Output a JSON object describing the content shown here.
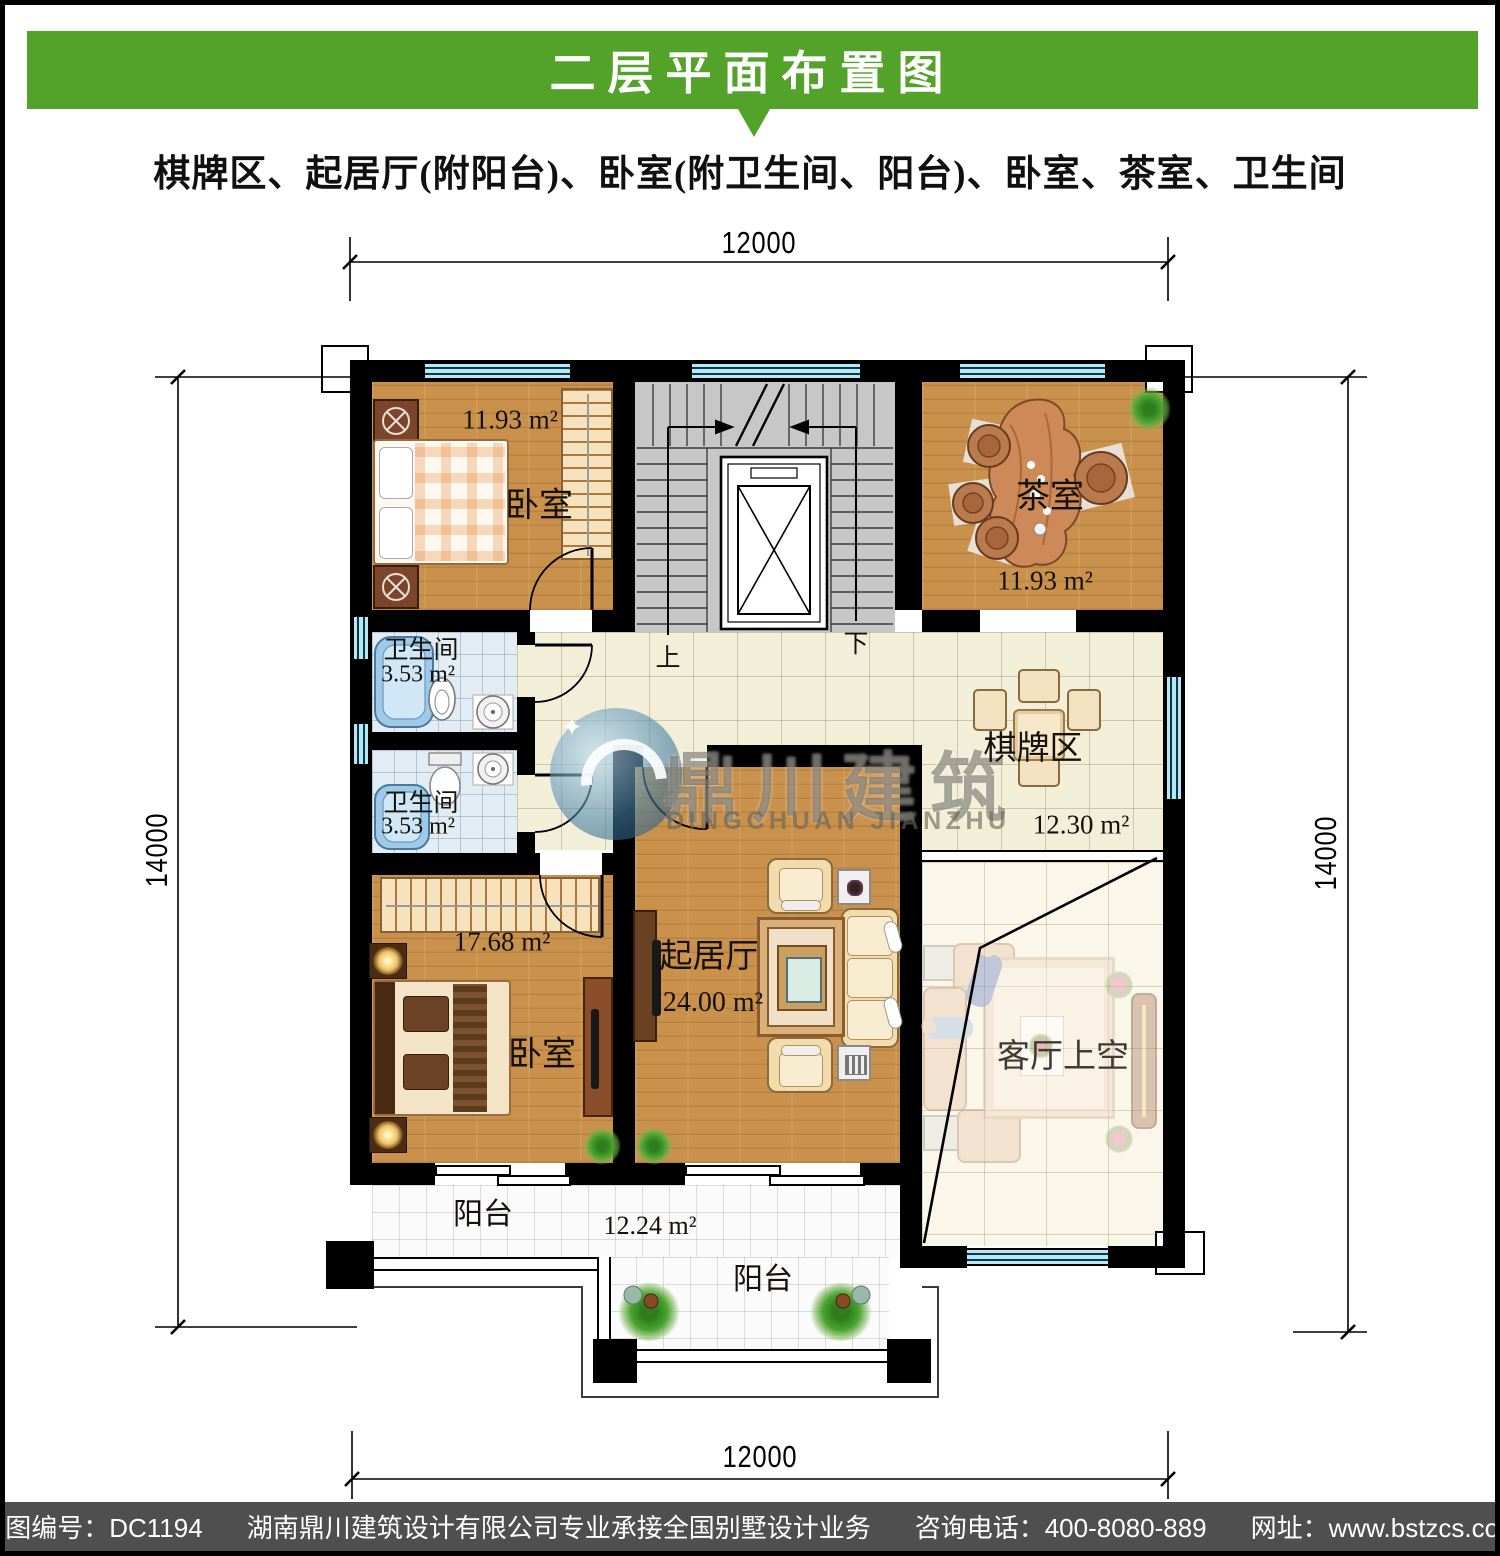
{
  "header": {
    "title": "二层平面布置图",
    "subtitle": "棋牌区、起居厅(附阳台)、卧室(附卫生间、阳台)、卧室、茶室、卫生间"
  },
  "dimensions": {
    "top": "12000",
    "bottom": "12000",
    "left": "14000",
    "right": "14000"
  },
  "rooms": {
    "bedroom_top": {
      "name": "卧室",
      "area": "11.93 m²"
    },
    "tea_room": {
      "name": "茶室",
      "area": "11.93 m²"
    },
    "bath_1": {
      "name": "卫生间",
      "area": "3.53 m²"
    },
    "bath_2": {
      "name": "卫生间",
      "area": "3.53 m²"
    },
    "chess_area": {
      "name": "棋牌区",
      "area": "12.30 m²"
    },
    "bedroom_bottom": {
      "name": "卧室",
      "area": "17.68 m²"
    },
    "living_room": {
      "name": "起居厅",
      "area": "24.00 m²"
    },
    "void": {
      "name": "客厅上空"
    },
    "balcony_main": {
      "name": "阳台",
      "area": "12.24 m²"
    },
    "balcony_outer": {
      "name": "阳台"
    }
  },
  "stairs": {
    "up": "上",
    "down": "下"
  },
  "watermark": {
    "cn": "鼎川建筑",
    "en": "DINGCHUAN JIANZHU",
    "sparkle": "✦"
  },
  "footer": {
    "drawing_no": "本图编号：DC1194",
    "company": "湖南鼎川建筑设计有限公司专业承接全国别墅设计业务",
    "phone": "咨询电话：400-8080-889",
    "website": "网址：www.bstzcs.com"
  },
  "colors": {
    "header_green": "#53a32a",
    "footer_gray": "#4f4f4f",
    "wall_black": "#000000",
    "window_cyan": "#b8e6f4",
    "wood_floor": "#c9914c",
    "tile_beige": "#f3eed8",
    "bath_tile": "#e2ecf4",
    "stair_gray": "#c7c7c7"
  }
}
